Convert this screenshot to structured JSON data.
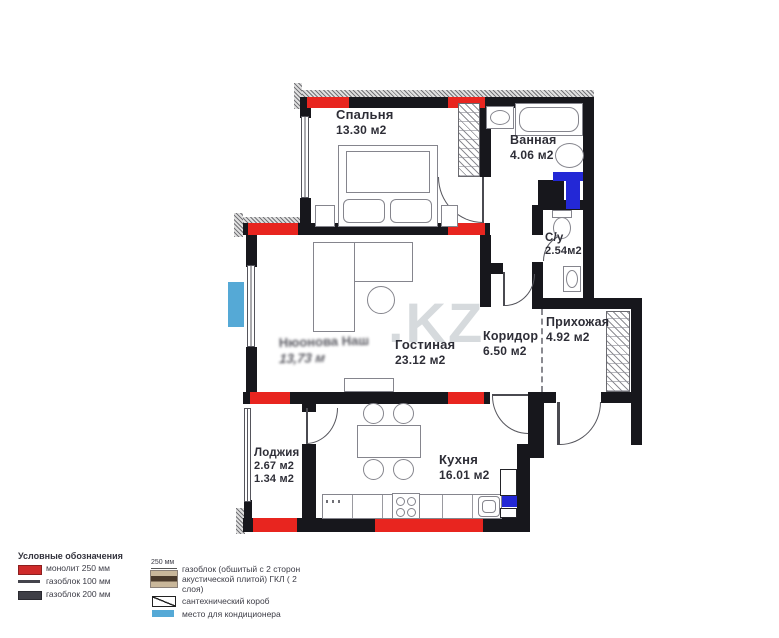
{
  "watermark": {
    "text": ".KZ"
  },
  "ghost_label": {
    "line1": "Нюонова Наш",
    "line2": "13,73 м"
  },
  "rooms": {
    "bedroom": {
      "name": "Спальня",
      "area": "13.30 м2"
    },
    "bathroom": {
      "name": "Ванная",
      "area": "4.06 м2"
    },
    "wc": {
      "name": "С/у",
      "area": "2.54м2"
    },
    "hallway": {
      "name": "Прихожая",
      "area": "4.92 м2"
    },
    "corridor": {
      "name": "Коридор",
      "area": "6.50 м2"
    },
    "living": {
      "name": "Гостиная",
      "area": "23.12 м2"
    },
    "loggia": {
      "name": "Лоджия",
      "area": "2.67 м2",
      "area2": "1.34 м2"
    },
    "kitchen": {
      "name": "Кухня",
      "area": "16.01 м2"
    }
  },
  "legend": {
    "title": "Условные обозначения",
    "size_note": "250 мм",
    "items_col1": [
      {
        "swatch": "monolith",
        "label": "монолит 250 мм"
      },
      {
        "swatch": "gasblock-100",
        "label": "газоблок 100 мм"
      },
      {
        "swatch": "gasblock-200",
        "label": "газоблок 200 мм"
      }
    ],
    "items_col2": [
      {
        "swatch": "acoustic",
        "label": "газоблок (обшитый с 2 сторон акустической плитой) ГКЛ ( 2 слоя)"
      },
      {
        "swatch": "sanitary-box",
        "label": "сантехнический короб"
      },
      {
        "swatch": "ac-place",
        "label": "место для кондиционера"
      }
    ]
  },
  "colors": {
    "monolith_red": "#e8251f",
    "wall_black": "#17171c",
    "sanitary_blue": "#2328d6",
    "ac_light_blue": "#55a9d6",
    "acoustic_tan": "#c9b79a",
    "acoustic_band": "#4a3a2b"
  }
}
